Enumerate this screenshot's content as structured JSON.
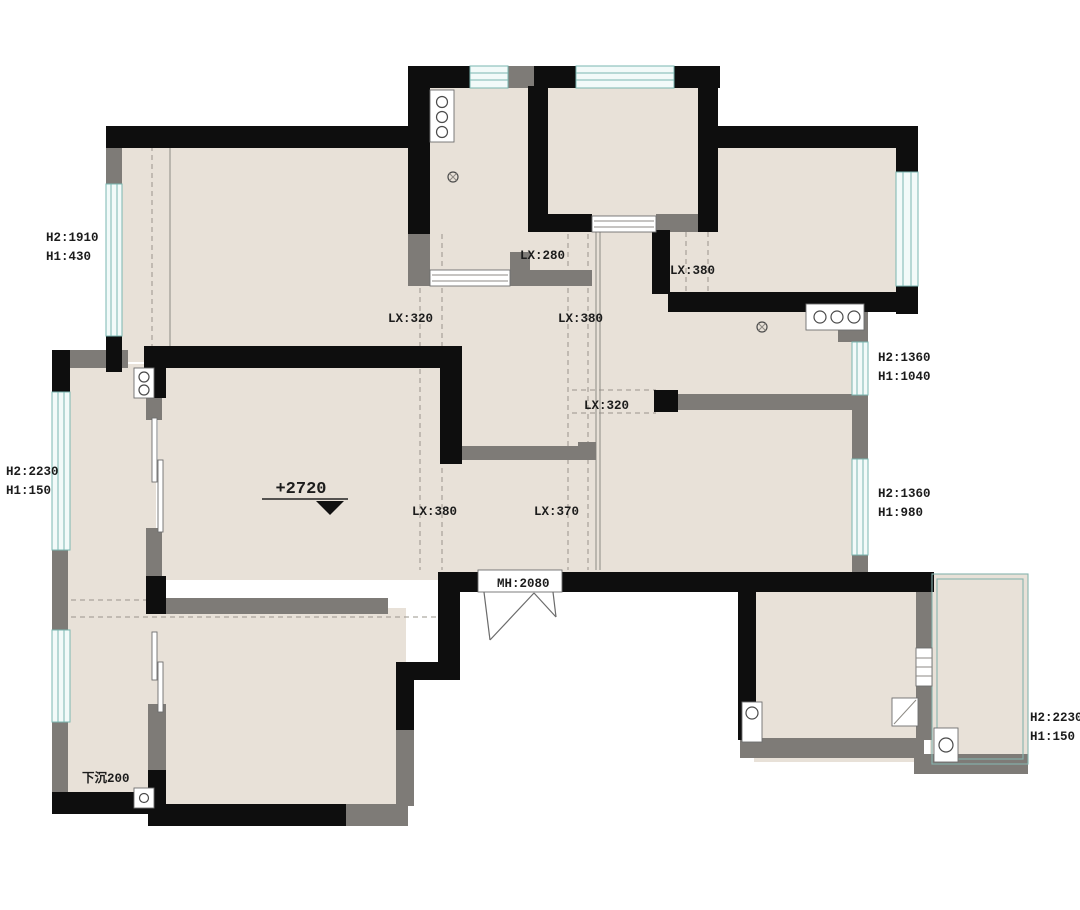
{
  "title": "apartment-floor-plan",
  "colors": {
    "wall_black": "#0e0e0e",
    "wall_gray": "#7e7b77",
    "floor_fill": "#e8e1d8",
    "window_line": "#7ab7b1",
    "window_fill": "#f2faf9",
    "dash_line": "#9a948b",
    "text": "#1c1c1c",
    "background": "#ffffff"
  },
  "labels": {
    "win_left_top_h2": "H2:1910",
    "win_left_top_h1": "H1:430",
    "win_left_mid_h2": "H2:2230",
    "win_left_mid_h1": "H1:150",
    "beam_kitchen": "LX:280",
    "beam_hall_left": "LX:320",
    "beam_hall_right": "LX:380",
    "beam_ne_room": "LX:380",
    "win_right_top_h2": "H2:1360",
    "win_right_top_h1": "H1:1040",
    "beam_center_hall": "LX:320",
    "elevation_mark": "+2720",
    "beam_living_left": "LX:380",
    "beam_living_right": "LX:370",
    "win_right_mid_h2": "H2:1360",
    "win_right_mid_h1": "H1:980",
    "entry_door_width": "MH:2080",
    "sunken_note": "下沉200",
    "win_right_bottom_h2": "H2:2230",
    "win_right_bottom_h1": "H1:150"
  }
}
